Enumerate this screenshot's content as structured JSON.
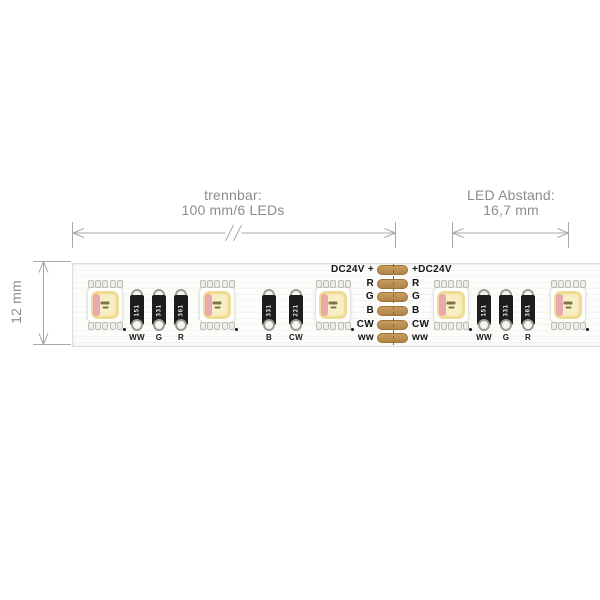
{
  "diagram": {
    "dim_cut": {
      "line1": "trennbar:",
      "line2": "100 mm/6 LEDs"
    },
    "dim_spacing": {
      "line1": "LED Abstand:",
      "line2": "16,7 mm"
    },
    "dim_height": {
      "label": "12 mm"
    },
    "pads": {
      "left": [
        "DC24V +",
        "R",
        "G",
        "B",
        "CW",
        "ww"
      ],
      "right": [
        "+DC24V",
        "R",
        "G",
        "B",
        "CW",
        "ww"
      ]
    },
    "resistor_groups": [
      {
        "items": [
          {
            "label": "WW",
            "value": "151"
          },
          {
            "label": "G",
            "value": "331"
          },
          {
            "label": "R",
            "value": "361"
          }
        ]
      },
      {
        "items": [
          {
            "label": "B",
            "value": "331"
          },
          {
            "label": "CW",
            "value": "221"
          }
        ]
      },
      {
        "items": [
          {
            "label": "WW",
            "value": "151"
          },
          {
            "label": "G",
            "value": "331"
          },
          {
            "label": "R",
            "value": "361"
          }
        ]
      }
    ],
    "colors": {
      "pad_copper": "#bf9055",
      "dimension_line": "#a8a8a8",
      "dimension_text": "#8c8c8c",
      "label_text": "#141414"
    }
  }
}
